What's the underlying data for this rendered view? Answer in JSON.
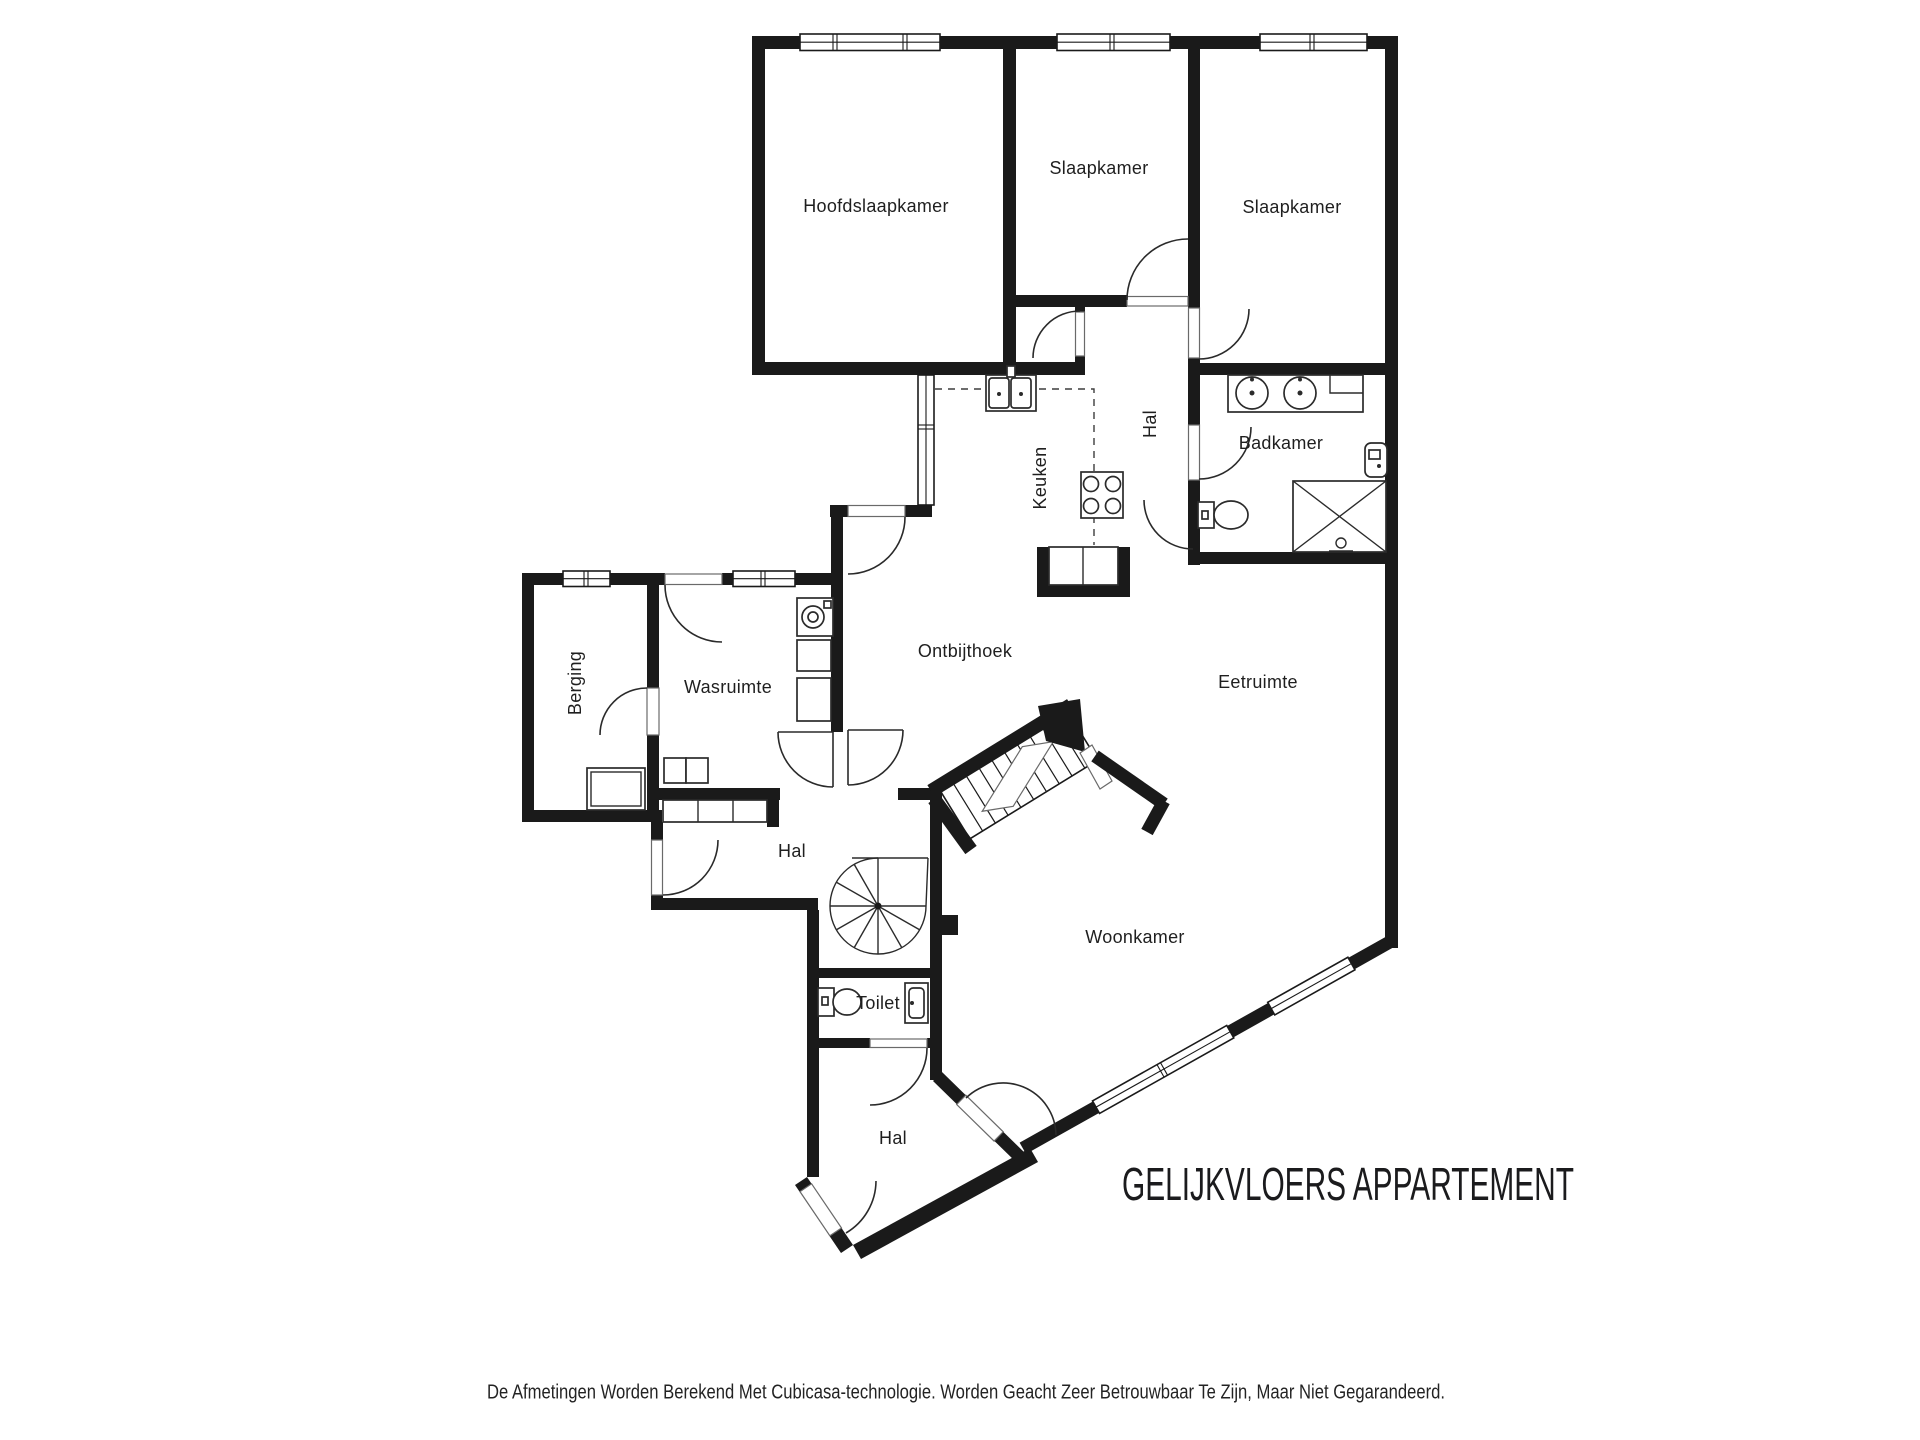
{
  "title": "GELIJKVLOERS APPARTEMENT",
  "footer": "De Afmetingen Worden Berekend Met Cubicasa-technologie. Worden Geacht Zeer Betrouwbaar Te Zijn, Maar Niet Gegarandeerd.",
  "colors": {
    "wall": "#1a1a1a",
    "background": "#ffffff",
    "label": "#1f1f1f"
  },
  "rooms": {
    "hoofdslaapkamer": "Hoofdslaapkamer",
    "slaapkamer_middle": "Slaapkamer",
    "slaapkamer_right": "Slaapkamer",
    "hal_boven": "Hal",
    "badkamer": "Badkamer",
    "keuken": "Keuken",
    "ontbijthoek": "Ontbijthoek",
    "eetruimte": "Eetruimte",
    "berging": "Berging",
    "wasruimte": "Wasruimte",
    "hal_midden": "Hal",
    "woonkamer": "Woonkamer",
    "toilet": "Toilet",
    "hal_onder": "Hal"
  }
}
